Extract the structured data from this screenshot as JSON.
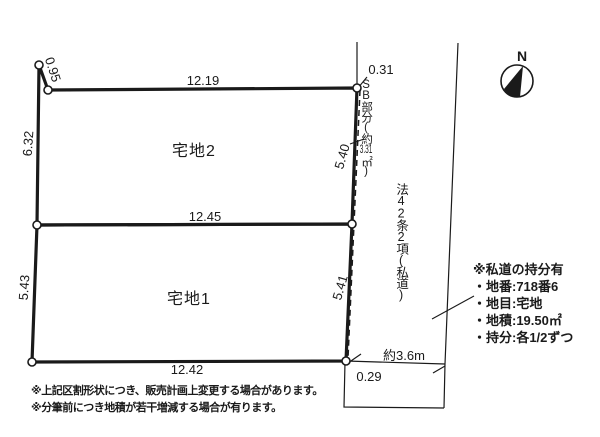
{
  "colors": {
    "ink": "#1a1a1a",
    "background": "#ffffff"
  },
  "parcels": {
    "parcel2": {
      "label": "宅地2",
      "top": "12.19",
      "bottom": "12.45",
      "left": "6.32",
      "right": "5.40",
      "corner": "0.95"
    },
    "parcel1": {
      "label": "宅地1",
      "bottom": "12.42",
      "left": "5.43",
      "right": "5.41"
    }
  },
  "setback": {
    "head": "SB部分(約",
    "area": "3.31",
    "unit": "㎡)",
    "top_offset": "0.31",
    "bottom_offset": "0.29"
  },
  "road": {
    "designation": "法42条2項(私道)",
    "width": "約3.6m"
  },
  "compass": {
    "label": "N"
  },
  "info_box": {
    "title": "※私道の持分有",
    "items": [
      "・地番:718番6",
      "・地目:宅地",
      "・地積:19.50㎡",
      "・持分:各1/2ずつ"
    ]
  },
  "notes": [
    "※上記区割形状につき、販売計画上変更する場合があります。",
    "※分筆前につき地積が若干増減する場合が有ります。"
  ]
}
